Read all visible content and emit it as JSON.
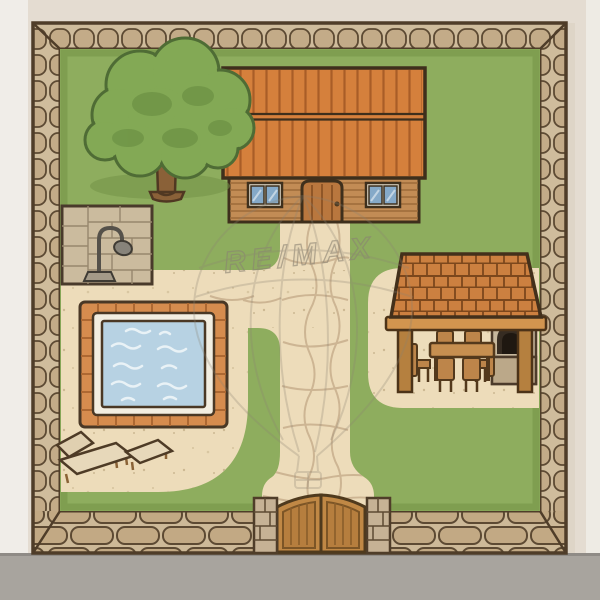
{
  "watermark": {
    "text": "RE/MAX"
  },
  "scene": {
    "type": "backyard-property-illustration",
    "elements": [
      "stone-wall-border",
      "lawn",
      "farm-house",
      "tree",
      "outdoor-shower",
      "swimming-pool",
      "sun-loungers",
      "stone-walkway",
      "pergola-dining-area",
      "dining-table-and-chairs",
      "pizza-oven",
      "wooden-gate",
      "gate-pillars",
      "sidewalk-road",
      "remax-balloon-watermark"
    ]
  },
  "palette": {
    "background": "#e4dcd1",
    "background_left_strip": "#f0ede8",
    "road_gray": "#a8a49e",
    "wall_stone": "#c3ab88",
    "wall_grout": "#cfbc9c",
    "dark_outline": "#4f3d29",
    "lawn_green": "#8ead5e",
    "lawn_shade": "#7c9a4c",
    "patio_tan": "#eddcba",
    "path_stone_line": "#c9b190",
    "roof_orange": "#d5803c",
    "roof_stripe": "#a95d27",
    "house_wood": "#c28c55",
    "furniture_wood": "#bf8a4e",
    "pergola_tile": "#cc8040",
    "pool_border": "#d68c4e",
    "pool_water": "#b7d2e3",
    "pool_rim": "#f3eee1",
    "gate_wood": "#c08845",
    "watermark_gray": "#8a8272"
  }
}
